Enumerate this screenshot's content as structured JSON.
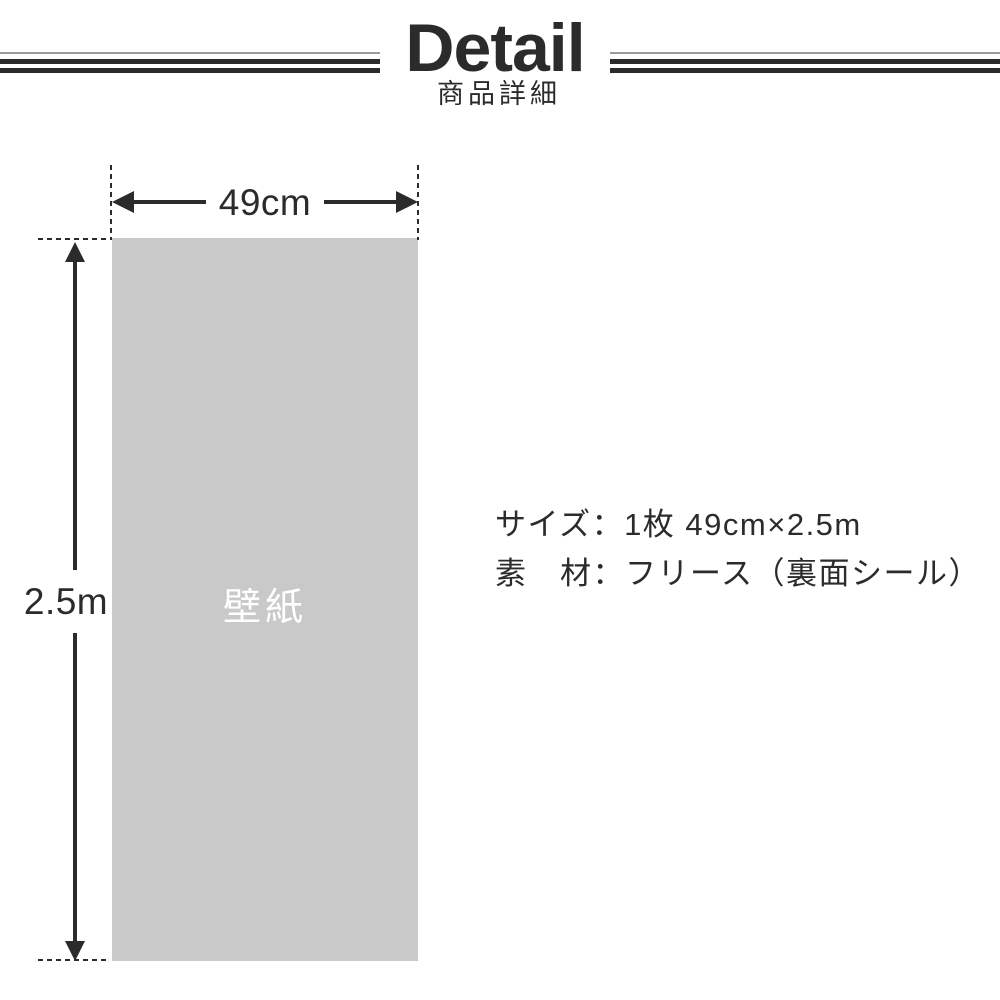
{
  "header": {
    "title": "Detail",
    "subtitle": "商品詳細"
  },
  "diagram": {
    "width_label": "49cm",
    "height_label": "2.5m",
    "panel_label": "壁紙"
  },
  "specs": {
    "size_line": "サイズ：1枚 49cm×2.5m",
    "material_line": "素　材：フリース（裏面シール）"
  },
  "colors": {
    "ink": "#2b2b2b",
    "panel_gray": "#c9c9c9",
    "rule_thin_gray": "#9b9b9b",
    "panel_text": "#ffffff"
  }
}
